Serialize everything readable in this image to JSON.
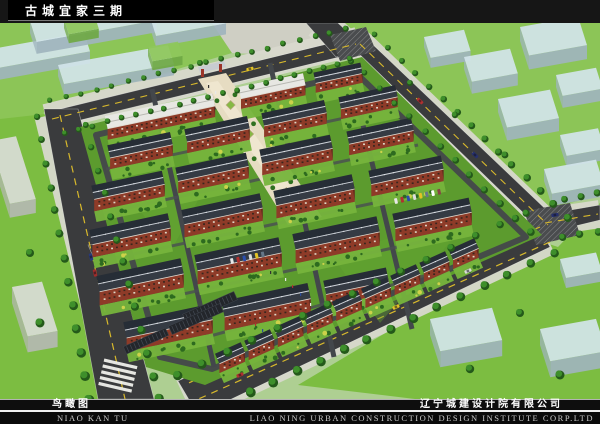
{
  "header": {
    "title": "古城宜家三期"
  },
  "footer": {
    "label_cn": "鸟瞰图",
    "label_en": "NIAO KAN TU",
    "company_cn": "辽宁城建设计院有限公司",
    "company_en": "LIAO NING URBAN CONSTRUCTION DESIGN INSTITUTE CORP.LTD"
  },
  "scene": {
    "palette": {
      "base": "#aecf92",
      "lawn_bright": "#8cc557",
      "lawn_mid": "#7cbd41",
      "site_green": "#5c9b2e",
      "garden": "#76b43c",
      "bush": "#2d6a1f",
      "bush_accent": "#ccd24a",
      "tree_dark": "#24591a",
      "tree_light": "#3e8f2b",
      "road": "#3a3b3d",
      "road_line": "#d8b92c",
      "road_edge": "rgba(255,255,255,0.5)",
      "inner_road": "#43474b",
      "hatch_base": "#4a4c4e",
      "sidewalk": "#d8d8ce",
      "plaza": "#e6dcc2",
      "plaza_light": "#efe6cf",
      "roof_dark": "#262d36",
      "roof_ridge": "#ced3d9",
      "roof_white": "#e7e7e2",
      "brick": "#8e3b28",
      "brick_dark": "#632a1c",
      "eave": "#dfdbd2",
      "ghost_top": "#d2e4ea",
      "ghost_side": "#9fb4bd",
      "ghost_green_top": "#8ec75b",
      "ghost_green_side": "#6fa844",
      "ghost_gray_top": "#d8dcd6",
      "ghost_gray_side": "#b4b8b2",
      "canopy": "#23262b"
    }
  }
}
